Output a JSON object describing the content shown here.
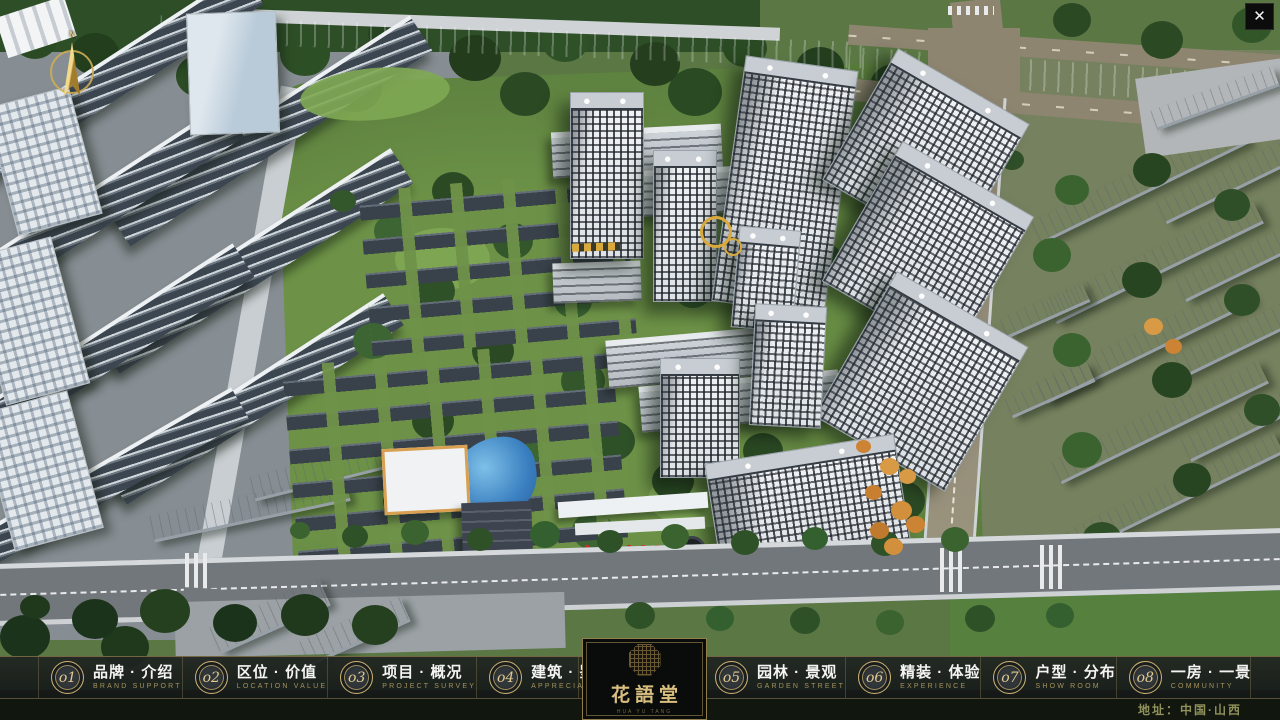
{
  "window": {
    "close_label": "✕"
  },
  "compass": {
    "marker": "N"
  },
  "menu": {
    "items": [
      {
        "num": "o1",
        "zh": "品牌 · 介绍",
        "en": "BRAND SUPPORT"
      },
      {
        "num": "o2",
        "zh": "区位 · 价值",
        "en": "LOCATION VALUE"
      },
      {
        "num": "o3",
        "zh": "项目 · 概况",
        "en": "PROJECT SURVEY"
      },
      {
        "num": "o4",
        "zh": "建筑 · 鉴赏",
        "en": "APPRECIATION"
      },
      {
        "num": "o5",
        "zh": "园林 · 景观",
        "en": "GARDEN STREET"
      },
      {
        "num": "o6",
        "zh": "精装 · 体验",
        "en": "EXPERIENCE"
      },
      {
        "num": "o7",
        "zh": "户型 · 分布",
        "en": "SHOW ROOM"
      },
      {
        "num": "o8",
        "zh": "一房 · 一景",
        "en": "COMMUNITY"
      }
    ]
  },
  "logo": {
    "name": "花語堂",
    "subtext": "HUA YU TANG"
  },
  "footer": {
    "address": "地址：中国·山西"
  },
  "colors": {
    "gold": "#cbb171",
    "bar_bg": "#1d211f",
    "river": "#2f62c4",
    "khaki_road": "#8d8570"
  }
}
